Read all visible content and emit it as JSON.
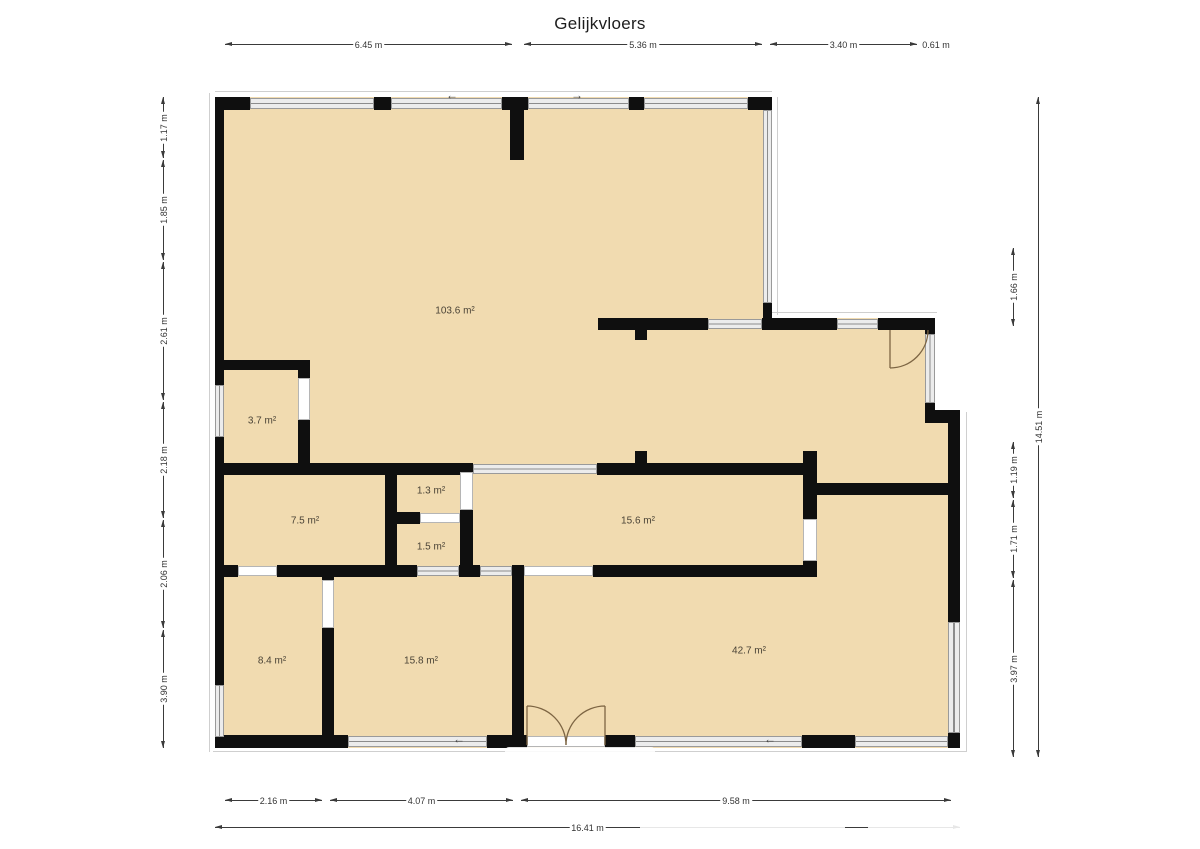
{
  "title": "Gelijkvloers",
  "colors": {
    "floor_fill": "#f1dbb0",
    "wall": "#0f0f0f",
    "window_glaze": "#8c8c8c",
    "dimension_line": "#3a3a3a",
    "door_arc": "#7d6543",
    "background": "#ffffff"
  },
  "rooms": [
    {
      "t": "103.6 m²",
      "x": 455,
      "y": 311
    },
    {
      "t": "3.7 m²",
      "x": 262,
      "y": 421
    },
    {
      "t": "7.5 m²",
      "x": 305,
      "y": 521
    },
    {
      "t": "1.3 m²",
      "x": 431,
      "y": 491
    },
    {
      "t": "1.5 m²",
      "x": 431,
      "y": 547
    },
    {
      "t": "15.6 m²",
      "x": 638,
      "y": 521
    },
    {
      "t": "8.4 m²",
      "x": 272,
      "y": 661
    },
    {
      "t": "15.8 m²",
      "x": 421,
      "y": 661
    },
    {
      "t": "42.7 m²",
      "x": 749,
      "y": 651
    }
  ],
  "dimensions": [
    {
      "o": "h",
      "pos": 44,
      "a": 225,
      "b": 512,
      "t": "6.45 m"
    },
    {
      "o": "h",
      "pos": 44,
      "a": 524,
      "b": 762,
      "t": "5.36 m"
    },
    {
      "o": "h",
      "pos": 44,
      "a": 770,
      "b": 917,
      "t": "3.40 m"
    },
    {
      "o": "h",
      "pos": 44,
      "a": 921,
      "b": 951,
      "t": "0.61 m"
    },
    {
      "o": "h",
      "pos": 800,
      "a": 225,
      "b": 322,
      "t": "2.16 m"
    },
    {
      "o": "h",
      "pos": 800,
      "a": 330,
      "b": 513,
      "t": "4.07 m"
    },
    {
      "o": "h",
      "pos": 800,
      "a": 521,
      "b": 951,
      "t": "9.58 m"
    },
    {
      "o": "h",
      "pos": 827,
      "a": 215,
      "b": 960,
      "t": "16.41 m"
    },
    {
      "o": "v",
      "pos": 163,
      "a": 97,
      "b": 158,
      "t": "1.17 m"
    },
    {
      "o": "v",
      "pos": 163,
      "a": 160,
      "b": 260,
      "t": "1.85 m"
    },
    {
      "o": "v",
      "pos": 163,
      "a": 262,
      "b": 400,
      "t": "2.61 m"
    },
    {
      "o": "v",
      "pos": 163,
      "a": 402,
      "b": 518,
      "t": "2.18 m"
    },
    {
      "o": "v",
      "pos": 163,
      "a": 520,
      "b": 628,
      "t": "2.06 m"
    },
    {
      "o": "v",
      "pos": 163,
      "a": 630,
      "b": 748,
      "t": "3.90 m"
    },
    {
      "o": "v",
      "pos": 1013,
      "a": 248,
      "b": 326,
      "t": "1.66 m"
    },
    {
      "o": "v",
      "pos": 1013,
      "a": 442,
      "b": 498,
      "t": "1.19 m"
    },
    {
      "o": "v",
      "pos": 1013,
      "a": 500,
      "b": 578,
      "t": "1.71 m"
    },
    {
      "o": "v",
      "pos": 1013,
      "a": 580,
      "b": 757,
      "t": "3.97 m"
    },
    {
      "o": "v",
      "pos": 1038,
      "a": 97,
      "b": 757,
      "t": "14.51 m"
    }
  ],
  "plan": {
    "floor": [
      [
        215,
        97,
        557,
        651
      ],
      [
        772,
        318,
        163,
        430
      ],
      [
        935,
        415,
        25,
        333
      ]
    ],
    "sills": [
      [
        215,
        91,
        557,
        1
      ],
      [
        777,
        97,
        1,
        218
      ],
      [
        772,
        312,
        165,
        1
      ],
      [
        209,
        93,
        1,
        659
      ],
      [
        966,
        412,
        1,
        340
      ],
      [
        213,
        751,
        753,
        1
      ]
    ],
    "walls": [
      [
        215,
        97,
        35,
        13
      ],
      [
        374,
        97,
        17,
        13
      ],
      [
        502,
        97,
        26,
        13
      ],
      [
        510,
        110,
        14,
        50
      ],
      [
        629,
        97,
        15,
        13
      ],
      [
        748,
        97,
        24,
        13
      ],
      [
        215,
        97,
        9,
        288
      ],
      [
        215,
        437,
        9,
        248
      ],
      [
        215,
        737,
        9,
        11
      ],
      [
        763,
        303,
        9,
        15
      ],
      [
        598,
        318,
        110,
        12
      ],
      [
        762,
        318,
        75,
        12
      ],
      [
        878,
        318,
        54,
        12
      ],
      [
        635,
        330,
        12,
        10
      ],
      [
        925,
        318,
        10,
        16
      ],
      [
        925,
        403,
        10,
        12
      ],
      [
        925,
        410,
        33,
        13
      ],
      [
        948,
        410,
        12,
        212
      ],
      [
        948,
        733,
        12,
        15
      ],
      [
        817,
        483,
        135,
        12
      ],
      [
        803,
        451,
        14,
        68
      ],
      [
        803,
        561,
        14,
        16
      ],
      [
        224,
        463,
        249,
        12
      ],
      [
        597,
        463,
        206,
        12
      ],
      [
        635,
        451,
        12,
        12
      ],
      [
        224,
        360,
        84,
        10
      ],
      [
        298,
        360,
        12,
        18
      ],
      [
        298,
        420,
        12,
        43
      ],
      [
        385,
        475,
        12,
        90
      ],
      [
        385,
        512,
        35,
        12
      ],
      [
        460,
        512,
        13,
        12
      ],
      [
        460,
        510,
        13,
        55
      ],
      [
        224,
        565,
        14,
        12
      ],
      [
        277,
        565,
        140,
        12
      ],
      [
        459,
        565,
        21,
        12
      ],
      [
        593,
        565,
        224,
        12
      ],
      [
        512,
        565,
        12,
        183
      ],
      [
        322,
        565,
        12,
        15
      ],
      [
        322,
        628,
        12,
        120
      ],
      [
        224,
        735,
        124,
        13
      ],
      [
        487,
        735,
        40,
        13
      ],
      [
        605,
        735,
        30,
        13
      ],
      [
        802,
        735,
        53,
        13
      ]
    ],
    "windows": [
      [
        250,
        98,
        124,
        11,
        "h"
      ],
      [
        391,
        98,
        111,
        11,
        "h"
      ],
      [
        528,
        98,
        101,
        11,
        "h"
      ],
      [
        644,
        98,
        104,
        11,
        "h"
      ],
      [
        215,
        385,
        9,
        52,
        "v"
      ],
      [
        215,
        685,
        9,
        52,
        "v"
      ],
      [
        763,
        110,
        9,
        193,
        "v"
      ],
      [
        708,
        319,
        54,
        10,
        "h"
      ],
      [
        837,
        319,
        41,
        10,
        "h"
      ],
      [
        925,
        334,
        10,
        69,
        "v"
      ],
      [
        948,
        622,
        12,
        111,
        "v"
      ],
      [
        473,
        464,
        124,
        10,
        "h"
      ],
      [
        417,
        566,
        42,
        10,
        "h"
      ],
      [
        480,
        566,
        32,
        10,
        "h"
      ],
      [
        348,
        736,
        139,
        11,
        "h"
      ],
      [
        635,
        736,
        167,
        11,
        "h"
      ],
      [
        855,
        736,
        93,
        11,
        "h"
      ],
      [
        298,
        378,
        12,
        42,
        "d"
      ],
      [
        460,
        472,
        13,
        38,
        "d"
      ],
      [
        420,
        513,
        40,
        10,
        "d"
      ],
      [
        803,
        519,
        14,
        42,
        "d"
      ],
      [
        238,
        566,
        39,
        10,
        "d"
      ],
      [
        524,
        566,
        69,
        10,
        "d"
      ],
      [
        322,
        580,
        12,
        48,
        "d"
      ],
      [
        527,
        736,
        78,
        11,
        "d"
      ]
    ],
    "door_arcs": [
      "M890 330 L890 368 M928 330 A38 38 0 0 1 890 368",
      "M527 745 L527 706 M527 706 A39 39 0 0 1 566 745",
      "M605 745 L605 706 M605 706 A39 39 0 0 0 566 745"
    ],
    "slide_arrows": [
      {
        "x": 452,
        "y": 95,
        "g": "←"
      },
      {
        "x": 577,
        "y": 95,
        "g": "→"
      },
      {
        "x": 459,
        "y": 739,
        "g": "←"
      },
      {
        "x": 770,
        "y": 739,
        "g": "←"
      }
    ],
    "watermark_patches": [
      [
        600,
        780,
        112,
        17
      ],
      [
        788,
        780,
        152,
        17
      ],
      [
        640,
        820,
        205,
        13
      ],
      [
        868,
        820,
        180,
        13
      ],
      [
        505,
        747,
        150,
        10
      ]
    ]
  }
}
